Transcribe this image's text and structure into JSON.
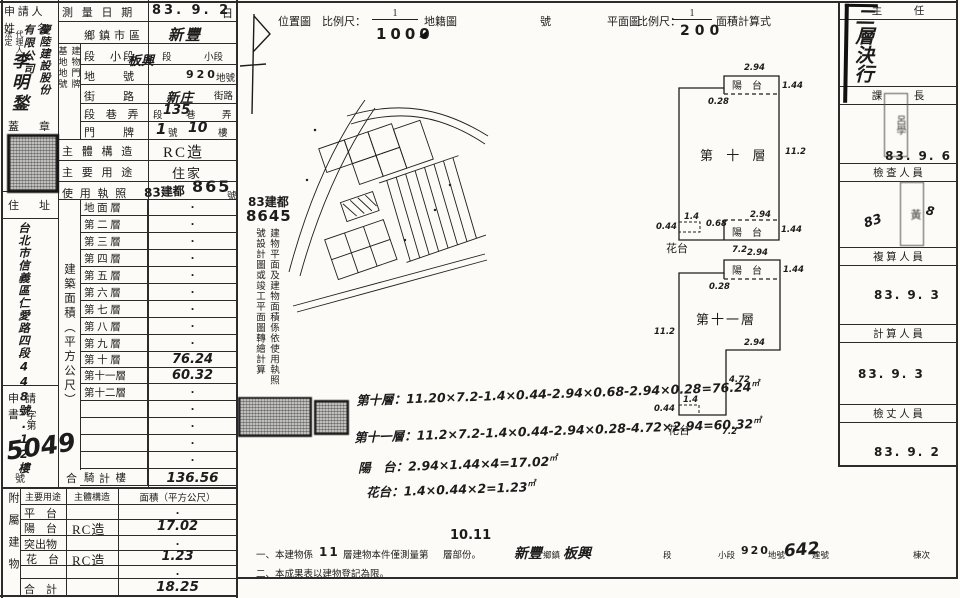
{
  "applicant": {
    "title_l1": "申 請 人",
    "title_l2": "姓　　名",
    "agent_col_left": "法定",
    "agent_col_right": "代理人",
    "company_right": "慶陸建設股份",
    "company_left": "有限公司",
    "name": "李明鍫",
    "seal_l": "蓋",
    "seal_r": "章",
    "address_l": "住",
    "address_r": "址",
    "address": "台北市信義區仁愛路四段448號.12樓",
    "application": "申請書",
    "docno_prefix": "字第",
    "docno": "5049",
    "docno_suffix": "號"
  },
  "form": {
    "survey_label": "測 量 日 期",
    "survey_value": "83. 9. 2",
    "survey_suffix": "日",
    "col_left": "基地地號",
    "col_right": "建物門牌",
    "town_label": "鄉鎮市區",
    "town_value": "新豐",
    "sec_label": "段　小段",
    "sec_hw": "板興",
    "sec_p1": "段",
    "sec_p2": "小段",
    "land_label": "地　　號",
    "land_value": "920",
    "land_suffix": "地號",
    "street_label": "街　　路",
    "street_hw": "新庄",
    "street_suffix": "街路",
    "lane_label": "段 巷 弄",
    "lane_p1": "段",
    "lane_hw": "135",
    "lane_p2": "巷",
    "lane_p3": "弄",
    "door_label": "門　　牌",
    "door_hw1": "1",
    "door_p1": "號",
    "door_hw2": "10",
    "door_p2": "樓",
    "struct_label": "主 體 構 造",
    "struct_value": "RC造",
    "use_label": "主 要 用 途",
    "use_value": "住家",
    "permit_label": "使 用 執 照",
    "permit_stamp": "83建都",
    "permit_hw": "865",
    "permit_suffix": "號"
  },
  "floors": {
    "side_label": "建築面積（平方公尺）",
    "rows": [
      {
        "label": "地 面 層",
        "value": "·"
      },
      {
        "label": "第 二 層",
        "value": "·"
      },
      {
        "label": "第 三 層",
        "value": "·"
      },
      {
        "label": "第 四 層",
        "value": "·"
      },
      {
        "label": "第 五 層",
        "value": "·"
      },
      {
        "label": "第 六 層",
        "value": "·"
      },
      {
        "label": "第 七 層",
        "value": "·"
      },
      {
        "label": "第 八 層",
        "value": "·"
      },
      {
        "label": "第 九 層",
        "value": "·"
      },
      {
        "label": "第 十 層",
        "value": "76.24"
      },
      {
        "label": "第十一層",
        "value": "60.32"
      },
      {
        "label": "第十二層",
        "value": "·"
      },
      {
        "label": "",
        "value": "·"
      },
      {
        "label": "",
        "value": "·"
      },
      {
        "label": "",
        "value": "·"
      },
      {
        "label": "",
        "value": "·"
      },
      {
        "label": "騎　　樓",
        "value": "·"
      }
    ],
    "total_label": "合　　計",
    "total_value": "136.56"
  },
  "attached": {
    "side": "附屬建物",
    "h_use": "主要用途",
    "h_struct": "主體構造",
    "h_area": "面積（平方公尺）",
    "rows": [
      {
        "use": "平　台",
        "struct": "",
        "area": "·"
      },
      {
        "use": "陽　台",
        "struct": "RC造",
        "area": "17.02"
      },
      {
        "use": "突出物",
        "struct": "",
        "area": "·"
      },
      {
        "use": "花　台",
        "struct": "RC造",
        "area": "1.23"
      },
      {
        "use": "",
        "struct": "",
        "area": "·"
      },
      {
        "use": "合　計",
        "struct": "",
        "area": "18.25"
      }
    ]
  },
  "middle": {
    "loc_label": "位置圖",
    "scale_label": "比例尺：",
    "num": "1",
    "loc_den": "1000",
    "cad_label": "地籍圖",
    "no_label": "號",
    "plan_label": "平面圖",
    "plan_den": "200",
    "calc_label": "面積計算式",
    "permit1": "83建都",
    "permit2": "8645",
    "permit_col1": "建物平面及建物面積係依使用執照",
    "permit_col2": "號設計圖或竣工平面圖轉繪計算",
    "calc": [
      "第十層：11.20×7.2-1.4×0.44-2.94×0.68-2.94×0.28=76.24",
      "第十一層：11.2×7.2-1.4×0.44-2.94×0.28-4.72×2.94=60.32",
      "陽　台：2.94×1.44×4=17.02",
      "花台：1.4×0.44×2=1.23"
    ],
    "sqm": "㎡",
    "hw_floors": "10.11",
    "n1a": "一、本建物係",
    "n1b": "11",
    "n1c": "層建物本件僅測量第",
    "n1d": "層部份。",
    "n1_town": "新豐",
    "n1_town_l": "鄉鎮",
    "n1_sec": "板興",
    "n1_sec_l": "段",
    "n1_sub_l": "小段",
    "n1_land": "920",
    "n1_land_l": "地號",
    "n1_bld": "642",
    "n1_bld_l": "建號",
    "n1_unit_l": "棟次",
    "note2": "二、本成果表以建物登記為限。"
  },
  "plans": {
    "p1": {
      "title": "第 十 層",
      "balcony_top": "陽　台",
      "balcony_bottom": "陽　台",
      "flower": "花台",
      "d_top": "2.94",
      "d_b1_r": "1.44",
      "d_b1_o": "0.28",
      "d_right": "11.2",
      "d_b2_l": "0.68",
      "d_b2_t": "2.94",
      "d_b2_r": "1.44",
      "d_fw": "1.4",
      "d_fh": "0.44",
      "d_bot": "7.2"
    },
    "p2": {
      "title": "第十一層",
      "balcony": "陽　台",
      "flower": "花台",
      "d_top": "2.94",
      "d_b_r": "1.44",
      "d_b_o": "0.28",
      "d_left": "11.2",
      "d_cut_w": "2.94",
      "d_cut_h": "4.72",
      "d_fw": "1.4",
      "d_fh": "0.44",
      "d_bot": "7.2"
    }
  },
  "sidebar": {
    "approval": "二層決行",
    "rows": [
      {
        "title": "主　　　任",
        "date": ""
      },
      {
        "title": "課　　　長",
        "date": "83. 9. 6",
        "stamp": "呂學"
      },
      {
        "title": "檢 查 人 員",
        "date": "",
        "stamp": "黃",
        "scribble1": "83",
        "scribble2": "8"
      },
      {
        "title": "複 算 人 員",
        "date": "83. 9. 3"
      },
      {
        "title": "計 算 人 員",
        "date": "83. 9. 3"
      },
      {
        "title": "檢 丈 人 員",
        "date": "83. 9. 2"
      }
    ]
  }
}
